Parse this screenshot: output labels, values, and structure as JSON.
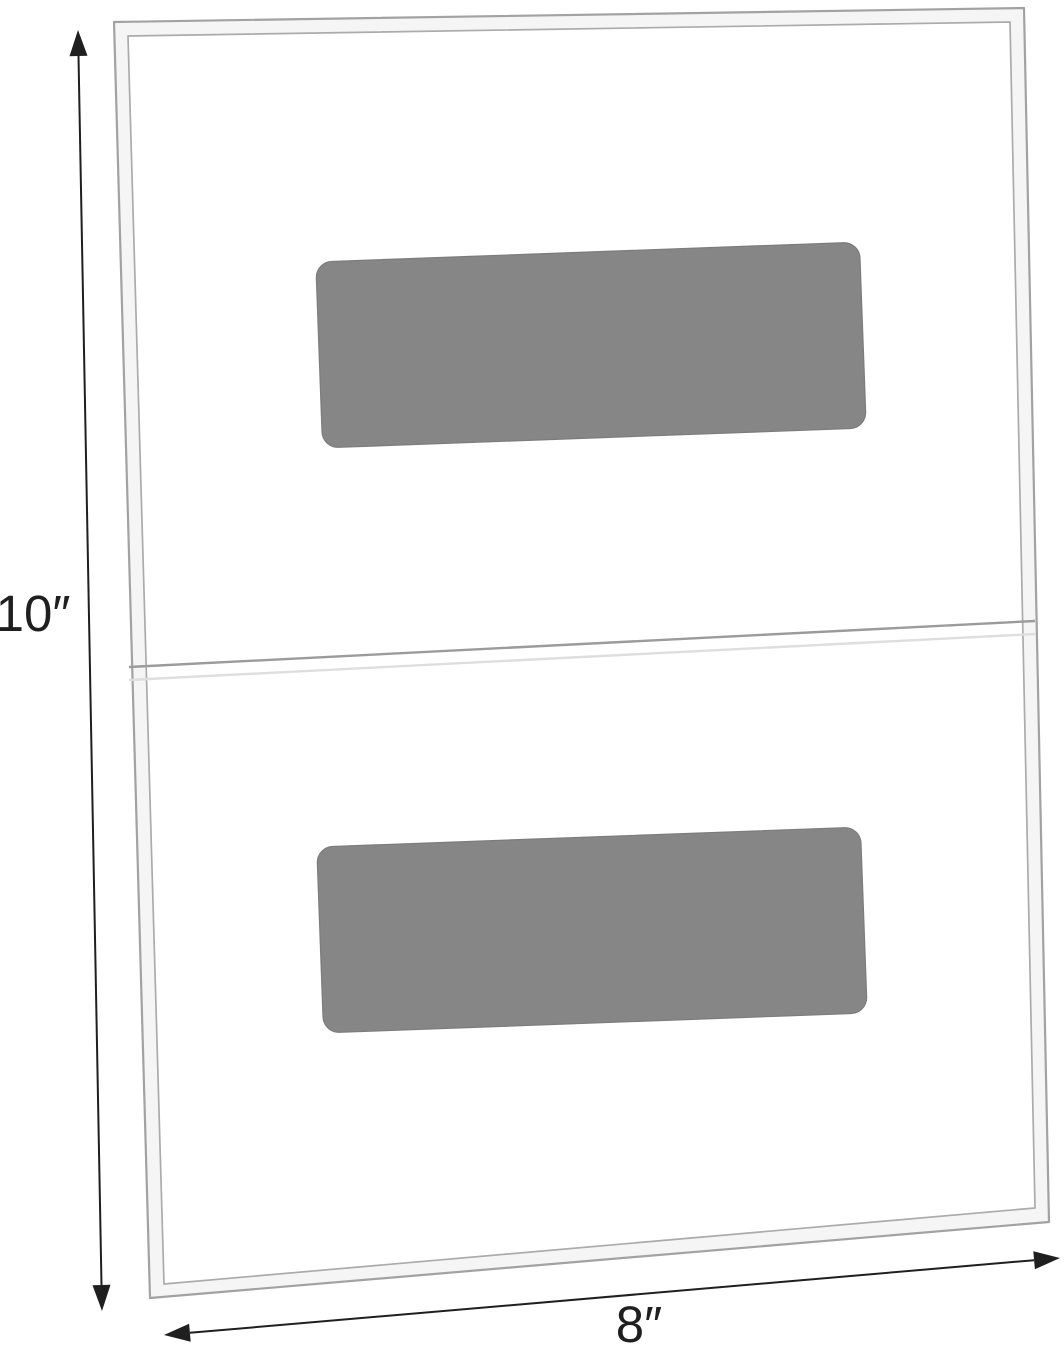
{
  "page": {
    "background": "#ffffff"
  },
  "diagram": {
    "kind": "product-dimension-diagram",
    "labels": {
      "height": "10″",
      "width": "8″"
    },
    "colors": {
      "background": "#ffffff",
      "panel_fill": "#ffffff",
      "panel_band_fill": "#f5f5f5",
      "panel_outer_stroke": "#a2a2a2",
      "panel_inner_stroke": "#ababab",
      "seam_line": "#9b9b9b",
      "seam_shadow": "#dedede",
      "pad_fill": "#868686",
      "pad_stroke": "#7c7c7c",
      "dimension_line": "#1f1f1f",
      "label_text": "#1f1f1f"
    }
  }
}
